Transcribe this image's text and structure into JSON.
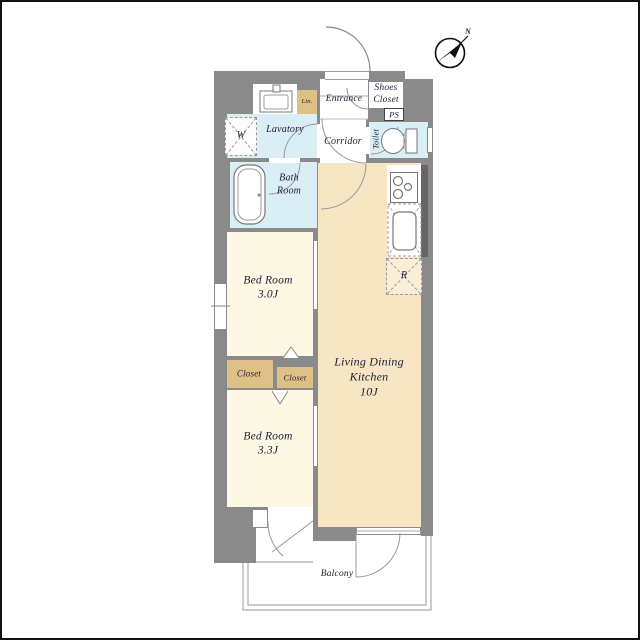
{
  "floorplan": {
    "compass": {
      "label": "N"
    },
    "rooms": {
      "entrance": {
        "name": "Entrance"
      },
      "shoes_closet": {
        "line1": "Shoes",
        "line2": "Closet"
      },
      "ps": {
        "name": "PS"
      },
      "linen": {
        "name": "Lin."
      },
      "lavatory": {
        "name": "Lavatory"
      },
      "washer": {
        "symbol": "W"
      },
      "corridor": {
        "name": "Corridor"
      },
      "toilet": {
        "name": "Toilet"
      },
      "bath": {
        "line1": "Bath",
        "line2": "Room"
      },
      "bedroom1": {
        "name": "Bed Room",
        "size": "3.0J"
      },
      "closet_left": {
        "name": "Closet"
      },
      "closet_right": {
        "name": "Closet"
      },
      "bedroom2": {
        "name": "Bed Room",
        "size": "3.3J"
      },
      "ldk": {
        "line1": "Living Dining",
        "line2": "Kitchen",
        "size": "10J"
      },
      "refrigerator": {
        "symbol": "R"
      },
      "balcony": {
        "name": "Balcony"
      }
    },
    "colors": {
      "wall": "#8a8a8a",
      "pillar": "#666666",
      "bedroom": "#fcf8e3",
      "ldk": "#f8e5c3",
      "closet": "#debf85",
      "wet_area": "#d9eef5",
      "balcony_line": "#9a9a9a",
      "text": "#20203a"
    }
  }
}
